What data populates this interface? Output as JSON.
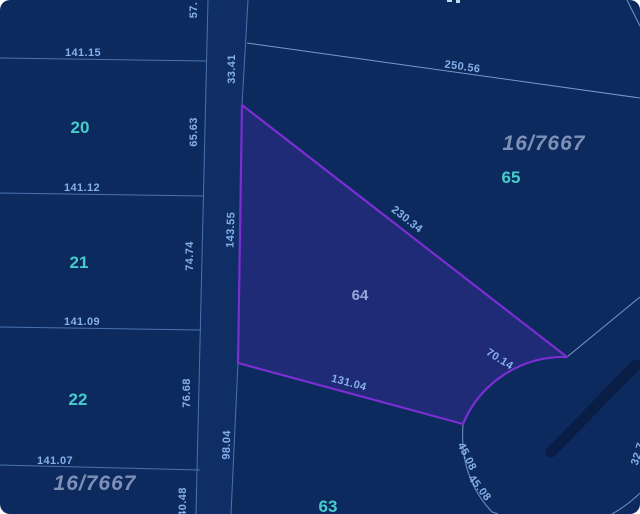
{
  "title": "Cadastral parcel map",
  "district": {
    "left_label": "16/7667",
    "right_label": "16/7667"
  },
  "parcels": {
    "p20": "20",
    "p21": "21",
    "p22": "22",
    "p63": "63",
    "p64": "64",
    "p65": "65"
  },
  "measurements": {
    "m57": "57.",
    "m33_41": "33.41",
    "m65_63": "65.63",
    "m143_55": "143.55",
    "m74_74": "74.74",
    "m76_68": "76.68",
    "m98_04": "98.04",
    "m40_48": "40.48",
    "m141_15": "141.15",
    "m141_12": "141.12",
    "m141_09": "141.09",
    "m141_07": "141.07",
    "m250_56": "250.56",
    "m230_34": "230.34",
    "m131_04": "131.04",
    "m70_14": "70.14",
    "m45_08_a": "45.08",
    "m45_08_b": "45.08",
    "m32_7": "32.7"
  },
  "colors": {
    "background": "#0d2a5f",
    "boundary_line": "#4a72ad",
    "light_line": "#7fa6d0",
    "measurement_text": "#85b0e8",
    "parcel_number": "#47cdc9",
    "selected_number": "#94a9d9",
    "selected_fill": "#202b77",
    "selected_stroke": "#7b2ed2",
    "district_text": "#7d90b6",
    "road_bar": "#0a1d47"
  }
}
